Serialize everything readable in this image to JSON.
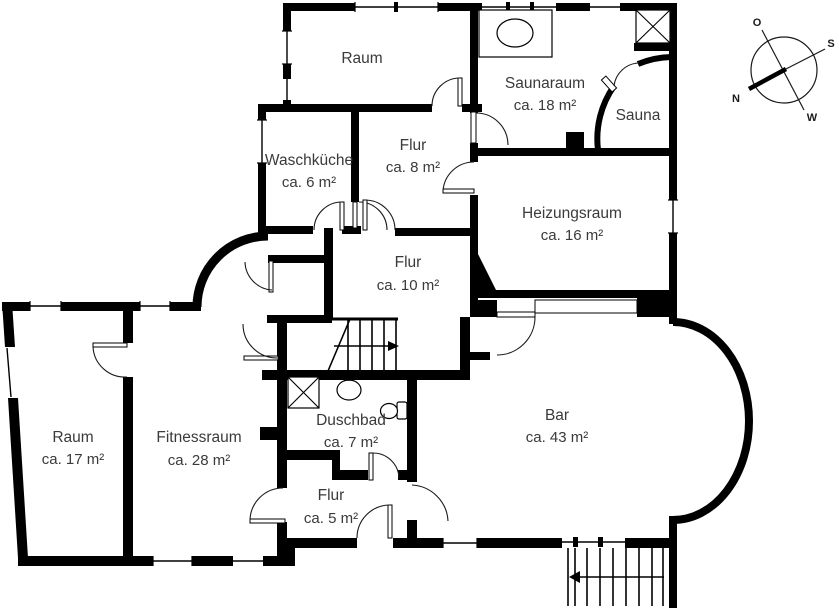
{
  "floorplan": {
    "rooms": [
      {
        "id": "raum-top",
        "name": "Raum",
        "area": ""
      },
      {
        "id": "saunaraum",
        "name": "Saunaraum",
        "area": "ca. 18 m²"
      },
      {
        "id": "sauna",
        "name": "Sauna",
        "area": ""
      },
      {
        "id": "waschkueche",
        "name": "Waschküche",
        "area": "ca. 6 m²"
      },
      {
        "id": "flur-og",
        "name": "Flur",
        "area": "ca. 8 m²"
      },
      {
        "id": "heizungsraum",
        "name": "Heizungsraum",
        "area": "ca. 16 m²"
      },
      {
        "id": "flur-mitte",
        "name": "Flur",
        "area": "ca. 10 m²"
      },
      {
        "id": "raum-links",
        "name": "Raum",
        "area": "ca. 17 m²"
      },
      {
        "id": "fitnessraum",
        "name": "Fitnessraum",
        "area": "ca. 28 m²"
      },
      {
        "id": "duschbad",
        "name": "Duschbad",
        "area": "ca. 7 m²"
      },
      {
        "id": "bar",
        "name": "Bar",
        "area": "ca. 43 m²"
      },
      {
        "id": "flur-unten",
        "name": "Flur",
        "area": "ca. 5 m²"
      }
    ],
    "compass": {
      "north": "N",
      "south": "S",
      "east": "O",
      "west": "W"
    },
    "colors": {
      "wall": "#000000",
      "text": "#3a3a3a",
      "background": "#ffffff"
    }
  }
}
